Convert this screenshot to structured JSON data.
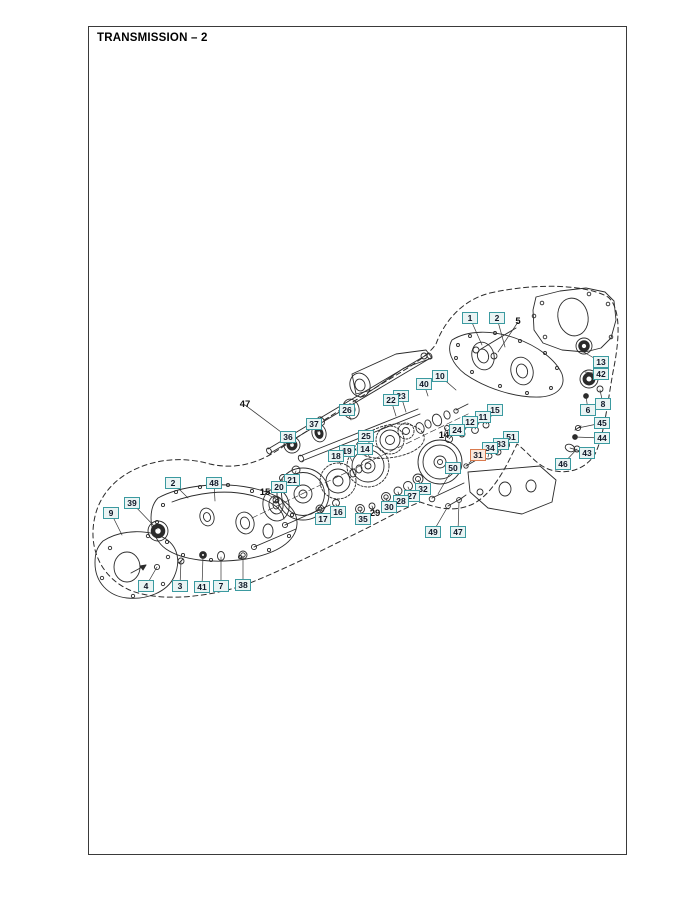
{
  "page": {
    "title": "TRANSMISSION – 2"
  },
  "colors": {
    "callout_border": "#3b9aa0",
    "callout_background": "#eaf4f4",
    "highlight_border": "#d97a4e",
    "highlight_background": "#f9e9de",
    "callout_text": "#101828",
    "line": "#2b2b2b"
  },
  "diagram": {
    "highlighted_part": "31",
    "callouts": [
      {
        "n": "1",
        "x": 470,
        "y": 318,
        "lx": 482,
        "ly": 345
      },
      {
        "n": "2",
        "x": 497,
        "y": 318,
        "lx": 505,
        "ly": 347
      },
      {
        "n": "5",
        "x": 518,
        "y": 322,
        "t": "plain",
        "lx": 498,
        "ly": 352
      },
      {
        "n": "13",
        "x": 601,
        "y": 362,
        "lx": 580,
        "ly": 350
      },
      {
        "n": "42",
        "x": 601,
        "y": 374,
        "lx": 585,
        "ly": 372
      },
      {
        "n": "8",
        "x": 603,
        "y": 404,
        "lx": 600,
        "ly": 390
      },
      {
        "n": "6",
        "x": 588,
        "y": 410,
        "lx": 586,
        "ly": 396
      },
      {
        "n": "45",
        "x": 602,
        "y": 423,
        "lx": 578,
        "ly": 428
      },
      {
        "n": "44",
        "x": 602,
        "y": 438,
        "lx": 575,
        "ly": 437
      },
      {
        "n": "43",
        "x": 587,
        "y": 453,
        "lx": 570,
        "ly": 448
      },
      {
        "n": "46",
        "x": 563,
        "y": 464,
        "lx": 577,
        "ly": 449
      },
      {
        "n": "10",
        "x": 440,
        "y": 376,
        "lx": 456,
        "ly": 390
      },
      {
        "n": "40",
        "x": 424,
        "y": 384,
        "lx": 428,
        "ly": 396
      },
      {
        "n": "23",
        "x": 401,
        "y": 396,
        "lx": 406,
        "ly": 412
      },
      {
        "n": "22",
        "x": 391,
        "y": 400,
        "lx": 396,
        "ly": 416
      },
      {
        "n": "26",
        "x": 347,
        "y": 410,
        "lx": 351,
        "ly": 420
      },
      {
        "n": "37",
        "x": 314,
        "y": 424,
        "lx": 319,
        "ly": 432
      },
      {
        "n": "36",
        "x": 288,
        "y": 437,
        "lx": 292,
        "ly": 444
      },
      {
        "n": "47",
        "x": 245,
        "y": 405,
        "t": "plain",
        "lx": 293,
        "ly": 441
      },
      {
        "n": "25",
        "x": 366,
        "y": 436,
        "lx": 371,
        "ly": 447
      },
      {
        "n": "14",
        "x": 365,
        "y": 449,
        "lx": 370,
        "ly": 458
      },
      {
        "n": "19",
        "x": 347,
        "y": 451,
        "lx": 352,
        "ly": 461
      },
      {
        "n": "18",
        "x": 336,
        "y": 456,
        "lx": 341,
        "ly": 465
      },
      {
        "n": "15",
        "x": 495,
        "y": 410,
        "lx": 486,
        "ly": 424
      },
      {
        "n": "11",
        "x": 483,
        "y": 417,
        "lx": 475,
        "ly": 429
      },
      {
        "n": "12",
        "x": 470,
        "y": 422,
        "lx": 462,
        "ly": 434
      },
      {
        "n": "24",
        "x": 457,
        "y": 430,
        "lx": 449,
        "ly": 439
      },
      {
        "n": "14",
        "x": 444,
        "y": 436,
        "t": "plain",
        "lx": 446,
        "ly": 428
      },
      {
        "n": "51",
        "x": 511,
        "y": 437,
        "lx": 506,
        "ly": 446
      },
      {
        "n": "33",
        "x": 501,
        "y": 444,
        "lx": 498,
        "ly": 453
      },
      {
        "n": "34",
        "x": 490,
        "y": 448,
        "lx": 488,
        "ly": 457
      },
      {
        "n": "31",
        "x": 478,
        "y": 455,
        "t": "hl",
        "lx": 469,
        "ly": 463
      },
      {
        "n": "50",
        "x": 453,
        "y": 468,
        "lx": 438,
        "ly": 494
      },
      {
        "n": "32",
        "x": 423,
        "y": 489,
        "lx": 418,
        "ly": 480
      },
      {
        "n": "27",
        "x": 412,
        "y": 496,
        "lx": 408,
        "ly": 487
      },
      {
        "n": "28",
        "x": 401,
        "y": 501,
        "lx": 398,
        "ly": 492
      },
      {
        "n": "30",
        "x": 389,
        "y": 507,
        "lx": 386,
        "ly": 498
      },
      {
        "n": "29",
        "x": 375,
        "y": 514,
        "t": "plain",
        "lx": 372,
        "ly": 506
      },
      {
        "n": "35",
        "x": 363,
        "y": 519,
        "lx": 360,
        "ly": 510
      },
      {
        "n": "16",
        "x": 338,
        "y": 512,
        "lx": 336,
        "ly": 504
      },
      {
        "n": "17",
        "x": 323,
        "y": 519,
        "lx": 320,
        "ly": 510
      },
      {
        "n": "21",
        "x": 292,
        "y": 480,
        "lx": 296,
        "ly": 471
      },
      {
        "n": "20",
        "x": 279,
        "y": 487,
        "lx": 283,
        "ly": 479
      },
      {
        "n": "15",
        "x": 265,
        "y": 493,
        "t": "plain",
        "lx": 276,
        "ly": 499
      },
      {
        "n": "49",
        "x": 433,
        "y": 532,
        "lx": 447,
        "ly": 508
      },
      {
        "n": "47",
        "x": 458,
        "y": 532,
        "lx": 459,
        "ly": 502
      },
      {
        "n": "2",
        "x": 173,
        "y": 483,
        "lx": 188,
        "ly": 498
      },
      {
        "n": "48",
        "x": 214,
        "y": 483,
        "lx": 215,
        "ly": 501
      },
      {
        "n": "39",
        "x": 132,
        "y": 503,
        "lx": 157,
        "ly": 529
      },
      {
        "n": "9",
        "x": 111,
        "y": 513,
        "lx": 122,
        "ly": 535
      },
      {
        "n": "4",
        "x": 146,
        "y": 586,
        "lx": 157,
        "ly": 567
      },
      {
        "n": "3",
        "x": 180,
        "y": 586,
        "lx": 181,
        "ly": 561
      },
      {
        "n": "41",
        "x": 202,
        "y": 587,
        "lx": 203,
        "ly": 556
      },
      {
        "n": "7",
        "x": 221,
        "y": 586,
        "lx": 221,
        "ly": 557
      },
      {
        "n": "38",
        "x": 243,
        "y": 585,
        "lx": 243,
        "ly": 556
      }
    ]
  }
}
